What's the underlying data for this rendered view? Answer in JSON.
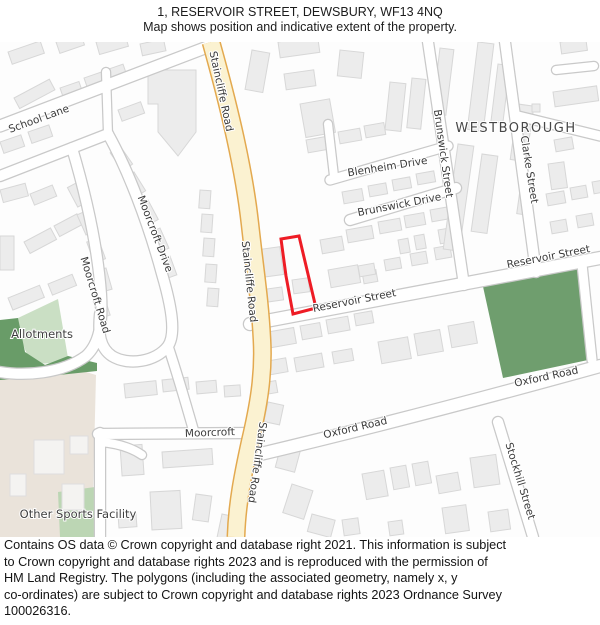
{
  "header": {
    "line1": "1, RESERVOIR STREET, DEWSBURY, WF13 4NQ",
    "line2": "Map shows position and indicative extent of the property."
  },
  "map": {
    "area_labels": {
      "westborough": "WESTBOROUGH",
      "allotments": "Allotments",
      "other_sports_facility": "Other Sports Facility"
    },
    "street_labels": {
      "school_lane": "School Lane",
      "staincliffe_road_top": "Staincliffe Road",
      "staincliffe_road_mid": "Staincliffe Road",
      "staincliffe_road_bottom": "Staincliffe Road",
      "moorcroft_drive": "Moorcroft Drive",
      "moorcroft_road": "Moorcroft Road",
      "moorcroft": "Moorcroft",
      "blenheim_drive": "Blenheim Drive",
      "brunswick_drive": "Brunswick Drive",
      "brunswick_street": "Brunswick Street",
      "clarke_street": "Clarke Street",
      "reservoir_street_left": "Reservoir Street",
      "reservoir_street_right": "Reservoir Street",
      "oxford_road_left": "Oxford Road",
      "oxford_road_right": "Oxford Road",
      "stockhill_street": "Stockhill Street"
    },
    "colors": {
      "property_outline": "#ee1c25",
      "major_road_fill": "#fbf2d1",
      "major_road_casing": "#e3a94f",
      "park_green": "#6f9e6e",
      "allotments_light": "#cadfc4",
      "allotments_dark": "#699c68",
      "sports_area_beige": "#eae3da",
      "building_fill": "#ececec"
    }
  },
  "footer": {
    "lines": [
      "Contains OS data © Crown copyright and database right 2021. This information is subject",
      "to Crown copyright and database rights 2023 and is reproduced with the permission of",
      "HM Land Registry. The polygons (including the associated geometry, namely x, y",
      "co-ordinates) are subject to Crown copyright and database rights 2023 Ordnance Survey",
      "100026316."
    ]
  }
}
